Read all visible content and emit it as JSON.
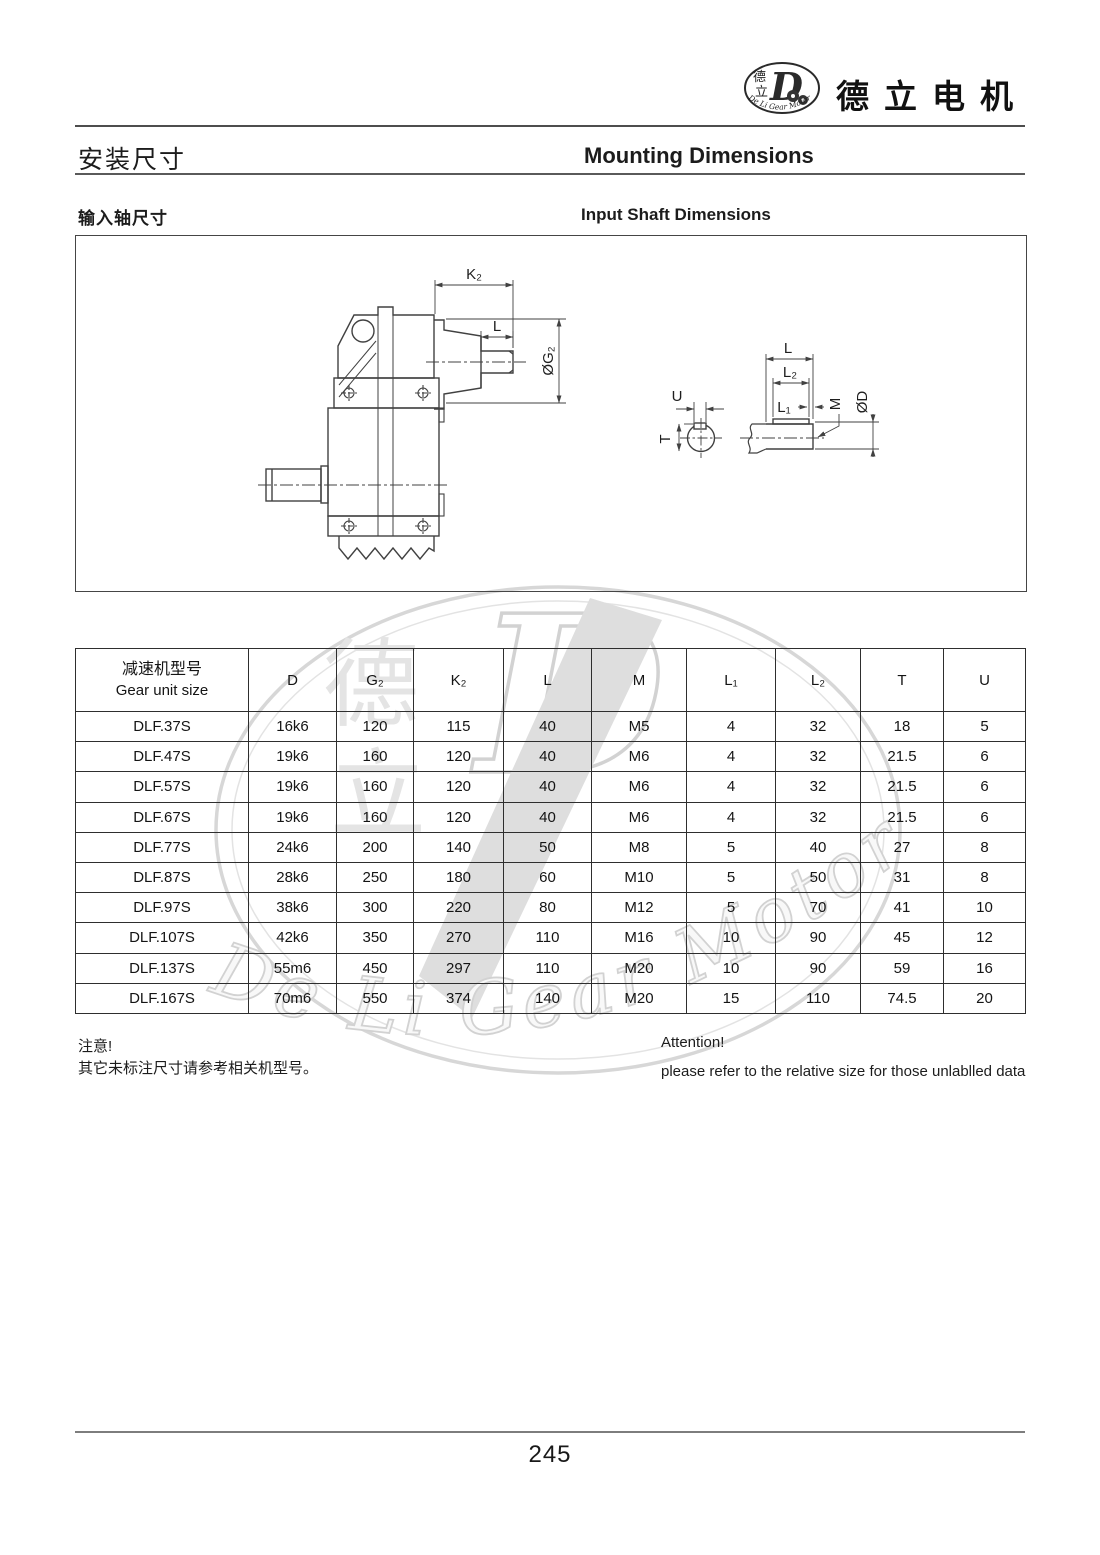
{
  "brand": {
    "name": "德立电机",
    "logo_cn_top": "德",
    "logo_cn_bottom": "立",
    "logo_d": "D",
    "logo_arc_text": "De Li Gear Motor"
  },
  "page_header": {
    "title_cn": "安装尺寸",
    "title_en": "Mounting Dimensions"
  },
  "section": {
    "title_cn": "输入轴尺寸",
    "title_en": "Input Shaft Dimensions"
  },
  "drawing": {
    "labels": {
      "k2": "K₂",
      "l_input": "L",
      "g2": "ØG₂",
      "u": "U",
      "t": "T",
      "l_shaft": "L",
      "l2": "L₂",
      "l1": "L₁",
      "m": "M",
      "d": "ØD"
    }
  },
  "table": {
    "col_header_cn": "减速机型号",
    "col_header_en": "Gear unit size",
    "columns": [
      "D",
      "G₂",
      "K₂",
      "L",
      "M",
      "L₁",
      "L₂",
      "T",
      "U"
    ],
    "rows": [
      {
        "model": "DLF.37S",
        "values": [
          "16k6",
          "120",
          "115",
          "40",
          "M5",
          "4",
          "32",
          "18",
          "5"
        ]
      },
      {
        "model": "DLF.47S",
        "values": [
          "19k6",
          "160",
          "120",
          "40",
          "M6",
          "4",
          "32",
          "21.5",
          "6"
        ]
      },
      {
        "model": "DLF.57S",
        "values": [
          "19k6",
          "160",
          "120",
          "40",
          "M6",
          "4",
          "32",
          "21.5",
          "6"
        ]
      },
      {
        "model": "DLF.67S",
        "values": [
          "19k6",
          "160",
          "120",
          "40",
          "M6",
          "4",
          "32",
          "21.5",
          "6"
        ]
      },
      {
        "model": "DLF.77S",
        "values": [
          "24k6",
          "200",
          "140",
          "50",
          "M8",
          "5",
          "40",
          "27",
          "8"
        ]
      },
      {
        "model": "DLF.87S",
        "values": [
          "28k6",
          "250",
          "180",
          "60",
          "M10",
          "5",
          "50",
          "31",
          "8"
        ]
      },
      {
        "model": "DLF.97S",
        "values": [
          "38k6",
          "300",
          "220",
          "80",
          "M12",
          "5",
          "70",
          "41",
          "10"
        ]
      },
      {
        "model": "DLF.107S",
        "values": [
          "42k6",
          "350",
          "270",
          "110",
          "M16",
          "10",
          "90",
          "45",
          "12"
        ]
      },
      {
        "model": "DLF.137S",
        "values": [
          "55m6",
          "450",
          "297",
          "110",
          "M20",
          "10",
          "90",
          "59",
          "16"
        ]
      },
      {
        "model": "DLF.167S",
        "values": [
          "70m6",
          "550",
          "374",
          "140",
          "M20",
          "15",
          "110",
          "74.5",
          "20"
        ]
      }
    ]
  },
  "notes": {
    "cn_title": "注意!",
    "cn_body": "其它未标注尺寸请参考相关机型号。",
    "en_title": "Attention!",
    "en_body": "please refer to the relative size for those unlablled data"
  },
  "watermark": {
    "d": "D",
    "cn_top": "德",
    "cn_bottom": "立",
    "script": "De Li Gear Motor"
  },
  "footer": {
    "page_number": "245"
  },
  "colors": {
    "ink": "#1c1c1c",
    "drawing_line": "#414141",
    "watermark": "#d6d6d6"
  }
}
